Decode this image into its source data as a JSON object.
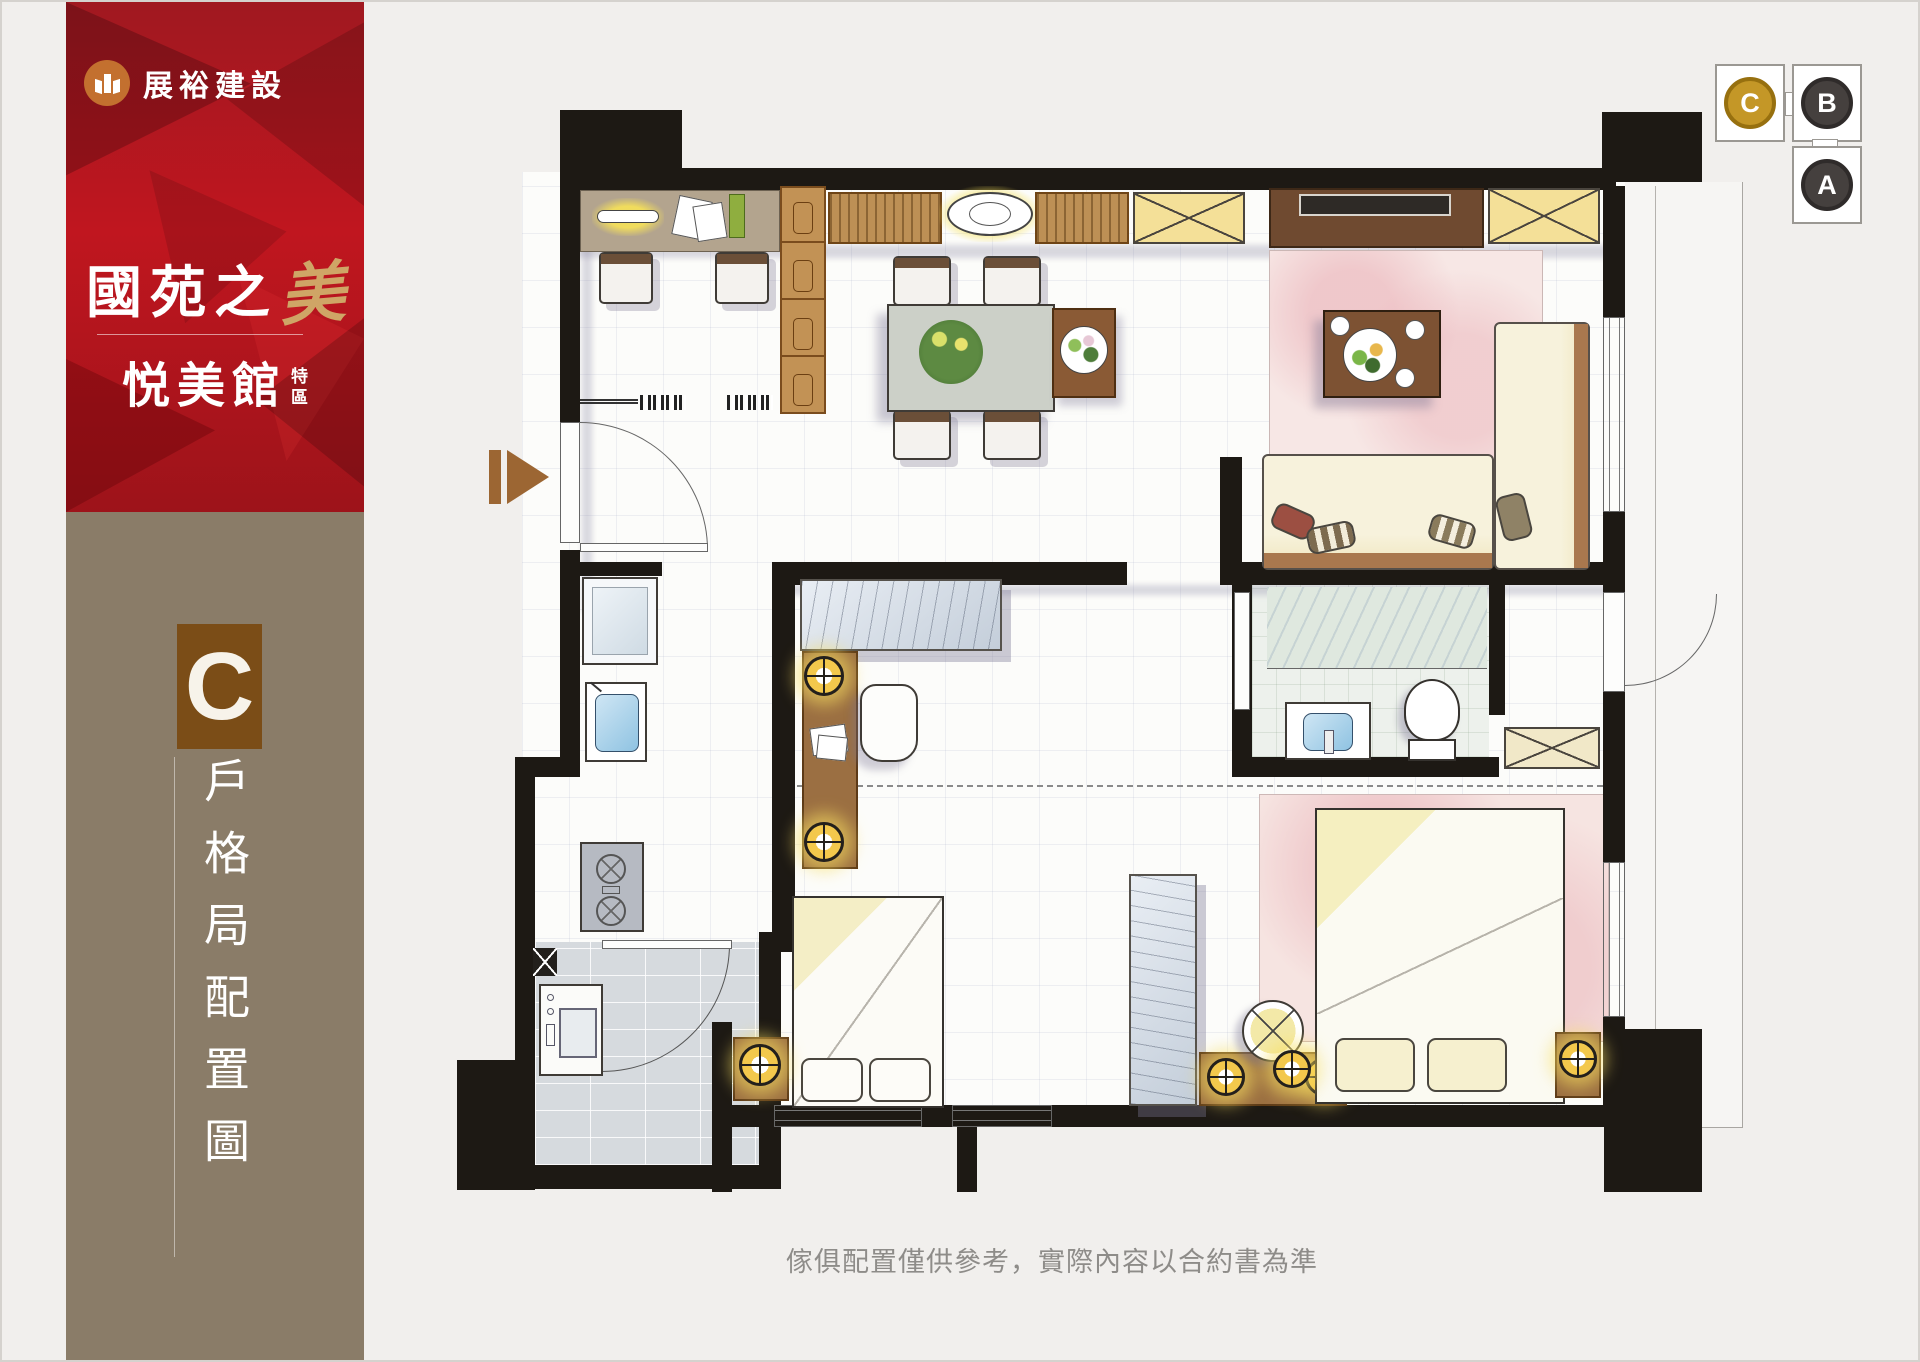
{
  "sidebar": {
    "logo": {
      "company": "展裕建設",
      "icon": "builder-book-icon",
      "icon_color": "#c3702f"
    },
    "title": {
      "prefix": "國苑之",
      "accent": "美"
    },
    "subtitle": {
      "name": "悦美館",
      "tag": [
        "特",
        "區"
      ]
    },
    "unit": {
      "letter": "C",
      "caption": "戶格局配置圖",
      "box_color": "#7b4d17"
    },
    "colors": {
      "red": "#b3141d",
      "taupe": "#8a7c68"
    }
  },
  "keyplan": {
    "units": [
      {
        "label": "C",
        "state": "highlighted",
        "color": "#c49727"
      },
      {
        "label": "B",
        "state": "normal",
        "color": "#45403e"
      },
      {
        "label": "A",
        "state": "normal",
        "color": "#45403e"
      }
    ]
  },
  "floorplan": {
    "entry_marker": "entry-arrow-icon",
    "wall_color": "#1d1914"
  },
  "footer": {
    "disclaimer": "傢俱配置僅供參考，實際內容以合約書為準"
  }
}
